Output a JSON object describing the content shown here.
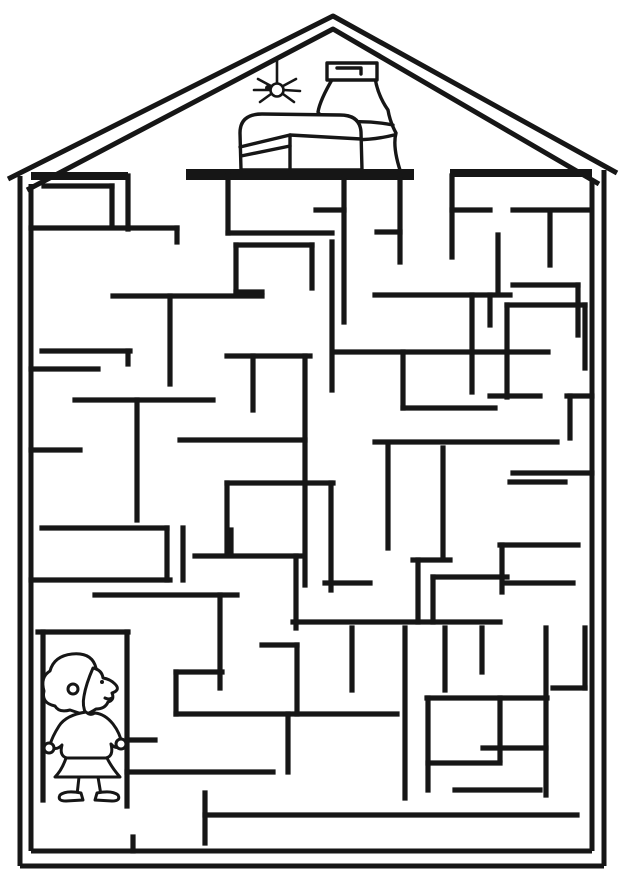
{
  "scene": {
    "width": 625,
    "height": 884,
    "background": "#ffffff",
    "ink_color": "#161616",
    "description_objects": [
      "house-outline",
      "attic-shelf",
      "treasure-chest",
      "jug",
      "spider",
      "maze-walls",
      "child-at-start"
    ]
  },
  "house": {
    "roof_outer_points": "8,179 333,16 617,173",
    "roof_inner_points": "27,190 333,29 599,184",
    "stroke": 5,
    "lines": [
      [
        20,
        176,
        20,
        866
      ],
      [
        31,
        184,
        31,
        851
      ],
      [
        604,
        170,
        604,
        866
      ],
      [
        592,
        180,
        592,
        851
      ],
      [
        20,
        866,
        604,
        866
      ],
      [
        31,
        851,
        592,
        851
      ]
    ],
    "attic_floor": [
      [
        31,
        176,
        128,
        176
      ],
      [
        450,
        173,
        592,
        173
      ]
    ],
    "attic_floor_stroke": 8
  },
  "attic": {
    "shelf": {
      "x": 186,
      "y": 169,
      "w": 228,
      "h": 11
    },
    "stroke": 3.4,
    "jug": [
      {
        "t": "path",
        "n": "jug-body",
        "d": "M333,78 Q320,100 318,112 Q326,122 322,133 Q330,145 315,170 L315,176 L402,176 Q392,148 396,133 Q390,122 388,110 Q378,96 375,78 Z",
        "fill": "#ffffff"
      },
      {
        "t": "path",
        "n": "jug-ring-top",
        "d": "M320,126 Q358,118 393,125"
      },
      {
        "t": "path",
        "n": "jug-ring-bottom",
        "d": "M321,136 Q358,144 394,135"
      },
      {
        "t": "path",
        "n": "jug-rim",
        "d": "M327,63 L377,63 L377,80 L327,80 Z",
        "fill": "#ffffff"
      },
      {
        "t": "path",
        "n": "jug-rim-inner",
        "d": "M337,68 L361,68 L361,74"
      }
    ],
    "chest": [
      {
        "t": "path",
        "n": "chest-outline",
        "d": "M241,170 L240,133 Q240,114 262,114 L340,115 Q360,115 361,132 L362,170 Z",
        "fill": "#ffffff"
      },
      {
        "t": "path",
        "n": "chest-lid-seam",
        "d": "M240,147 L290,135 L361,139"
      },
      {
        "t": "path",
        "n": "chest-panel-line",
        "d": "M290,135 L290,170"
      },
      {
        "t": "path",
        "n": "chest-band",
        "d": "M241,156 L290,146"
      }
    ],
    "spider": [
      {
        "t": "line",
        "n": "spider-thread",
        "x1": 277,
        "y1": 58,
        "x2": 277,
        "y2": 82
      },
      {
        "t": "circle",
        "n": "spider-body",
        "cx": 277,
        "cy": 90,
        "r": 6.5,
        "fill": "#ffffff"
      },
      {
        "t": "circle",
        "n": "spider-head",
        "cx": 268,
        "cy": 88,
        "r": 3,
        "fill": "#161616"
      },
      {
        "t": "path",
        "n": "spider-legs-left",
        "d": "M271,86 L258,79 M270,90 L254,90 M271,94 L260,102"
      },
      {
        "t": "path",
        "n": "spider-legs-right",
        "d": "M283,86 L296,79 M284,90 L300,91 M283,94 L294,102"
      }
    ]
  },
  "maze": {
    "stroke": 5.2,
    "walls": [
      [
        128,
        176,
        128,
        229
      ],
      [
        44,
        186,
        112,
        186
      ],
      [
        112,
        186,
        112,
        225
      ],
      [
        31,
        228,
        177,
        228
      ],
      [
        177,
        228,
        177,
        242
      ],
      [
        228,
        176,
        228,
        233
      ],
      [
        228,
        233,
        332,
        233
      ],
      [
        236,
        245,
        312,
        245
      ],
      [
        236,
        245,
        236,
        292
      ],
      [
        236,
        292,
        262,
        292
      ],
      [
        312,
        245,
        312,
        288
      ],
      [
        332,
        242,
        332,
        390
      ],
      [
        113,
        296,
        262,
        296
      ],
      [
        170,
        296,
        170,
        384
      ],
      [
        400,
        180,
        400,
        262
      ],
      [
        452,
        176,
        452,
        257
      ],
      [
        452,
        210,
        490,
        210
      ],
      [
        513,
        210,
        587,
        210
      ],
      [
        550,
        212,
        550,
        265
      ],
      [
        498,
        235,
        498,
        290
      ],
      [
        513,
        285,
        578,
        285
      ],
      [
        578,
        285,
        578,
        335
      ],
      [
        344,
        181,
        344,
        322
      ],
      [
        316,
        210,
        344,
        210
      ],
      [
        377,
        232,
        400,
        232
      ],
      [
        375,
        295,
        510,
        295
      ],
      [
        472,
        295,
        472,
        392
      ],
      [
        490,
        295,
        490,
        325
      ],
      [
        507,
        305,
        585,
        305
      ],
      [
        507,
        305,
        507,
        397
      ],
      [
        585,
        305,
        585,
        368
      ],
      [
        490,
        396,
        540,
        396
      ],
      [
        567,
        396,
        592,
        396
      ],
      [
        570,
        396,
        570,
        438
      ],
      [
        227,
        356,
        310,
        356
      ],
      [
        305,
        356,
        305,
        585
      ],
      [
        253,
        356,
        253,
        410
      ],
      [
        337,
        352,
        548,
        352
      ],
      [
        403,
        352,
        403,
        408
      ],
      [
        403,
        408,
        495,
        408
      ],
      [
        75,
        400,
        213,
        400
      ],
      [
        137,
        400,
        137,
        520
      ],
      [
        31,
        450,
        80,
        450
      ],
      [
        42,
        351,
        130,
        351
      ],
      [
        128,
        351,
        128,
        364
      ],
      [
        31,
        369,
        98,
        369
      ],
      [
        42,
        528,
        167,
        528
      ],
      [
        167,
        528,
        167,
        580
      ],
      [
        31,
        580,
        170,
        580
      ],
      [
        183,
        528,
        183,
        580
      ],
      [
        180,
        440,
        305,
        440
      ],
      [
        227,
        483,
        333,
        483
      ],
      [
        331,
        483,
        331,
        590
      ],
      [
        227,
        483,
        227,
        552
      ],
      [
        195,
        556,
        302,
        556
      ],
      [
        296,
        556,
        296,
        628
      ],
      [
        95,
        595,
        237,
        595
      ],
      [
        220,
        595,
        220,
        688
      ],
      [
        231,
        530,
        231,
        552
      ],
      [
        38,
        632,
        128,
        632
      ],
      [
        43,
        632,
        43,
        800
      ],
      [
        127,
        632,
        127,
        806
      ],
      [
        127,
        740,
        155,
        740
      ],
      [
        176,
        672,
        176,
        714
      ],
      [
        176,
        672,
        222,
        672
      ],
      [
        176,
        714,
        397,
        714
      ],
      [
        288,
        714,
        288,
        772
      ],
      [
        127,
        772,
        273,
        772
      ],
      [
        297,
        645,
        297,
        714
      ],
      [
        262,
        645,
        297,
        645
      ],
      [
        352,
        628,
        352,
        690
      ],
      [
        325,
        583,
        370,
        583
      ],
      [
        293,
        622,
        500,
        622
      ],
      [
        418,
        560,
        418,
        622
      ],
      [
        413,
        560,
        450,
        560
      ],
      [
        433,
        577,
        507,
        577
      ],
      [
        433,
        577,
        433,
        622
      ],
      [
        443,
        448,
        443,
        556
      ],
      [
        375,
        442,
        557,
        442
      ],
      [
        388,
        444,
        388,
        548
      ],
      [
        510,
        482,
        565,
        482
      ],
      [
        500,
        545,
        578,
        545
      ],
      [
        502,
        545,
        502,
        592
      ],
      [
        507,
        583,
        573,
        583
      ],
      [
        513,
        473,
        592,
        473
      ],
      [
        405,
        628,
        405,
        798
      ],
      [
        445,
        628,
        445,
        690
      ],
      [
        482,
        628,
        482,
        672
      ],
      [
        427,
        698,
        547,
        698
      ],
      [
        500,
        698,
        500,
        760
      ],
      [
        428,
        698,
        428,
        790
      ],
      [
        428,
        763,
        500,
        763
      ],
      [
        455,
        790,
        540,
        790
      ],
      [
        546,
        628,
        546,
        795
      ],
      [
        483,
        748,
        546,
        748
      ],
      [
        553,
        688,
        585,
        688
      ],
      [
        585,
        628,
        585,
        688
      ],
      [
        205,
        793,
        205,
        843
      ],
      [
        205,
        815,
        577,
        815
      ],
      [
        133,
        837,
        133,
        851
      ]
    ]
  },
  "child": {
    "stroke": 3,
    "parts": [
      {
        "t": "path",
        "n": "child-hair",
        "d": "M96,668 Q92,652 72,654 Q54,656 50,671 Q40,677 44,691 Q41,703 55,706 Q59,713 70,710 L85,715 Q90,710 87,700 Q88,688 92,682 Z",
        "fill": "#ffffff"
      },
      {
        "t": "path",
        "n": "child-face",
        "d": "M93,668 Q102,670 103,678 Q110,679 115,684 Q121,690 112,693 Q115,700 108,702 Q105,709 96,709 Q90,713 86,714 Q82,706 84,696 Q86,684 93,668 Z",
        "fill": "#ffffff"
      },
      {
        "t": "circle",
        "n": "child-eye",
        "cx": 102,
        "cy": 682,
        "r": 2,
        "fill": "#161616"
      },
      {
        "t": "path",
        "n": "child-mouth",
        "d": "M105,698 Q109,700 112,698"
      },
      {
        "t": "circle",
        "n": "child-hair-curl",
        "cx": 73,
        "cy": 689,
        "r": 5
      },
      {
        "t": "path",
        "n": "child-shirt",
        "d": "M86,712 Q66,715 59,726 Q52,737 50,745 Q55,752 62,745 Q59,756 67,758 L106,758 Q114,756 111,744 Q117,751 122,744 Q120,733 113,724 Q105,714 95,713 Q90,716 86,712 Z",
        "fill": "#ffffff"
      },
      {
        "t": "circle",
        "n": "child-hand-left",
        "cx": 49,
        "cy": 748,
        "r": 5,
        "fill": "#ffffff"
      },
      {
        "t": "circle",
        "n": "child-hand-right",
        "cx": 121,
        "cy": 744,
        "r": 5,
        "fill": "#ffffff"
      },
      {
        "t": "path",
        "n": "child-skirt",
        "d": "M66,758 Q62,770 55,777 L120,777 Q112,768 107,758 Z",
        "fill": "#ffffff"
      },
      {
        "t": "path",
        "n": "child-leg-left",
        "d": "M79,777 L77,795"
      },
      {
        "t": "path",
        "n": "child-leg-right",
        "d": "M98,777 L101,795"
      },
      {
        "t": "path",
        "n": "child-shoe-left",
        "d": "M81,793 Q66,790 60,795 Q57,801 66,801 L83,800 Z",
        "fill": "#ffffff"
      },
      {
        "t": "path",
        "n": "child-shoe-right",
        "d": "M97,793 Q112,790 118,795 Q121,801 112,801 L95,800 Z",
        "fill": "#ffffff"
      }
    ]
  }
}
